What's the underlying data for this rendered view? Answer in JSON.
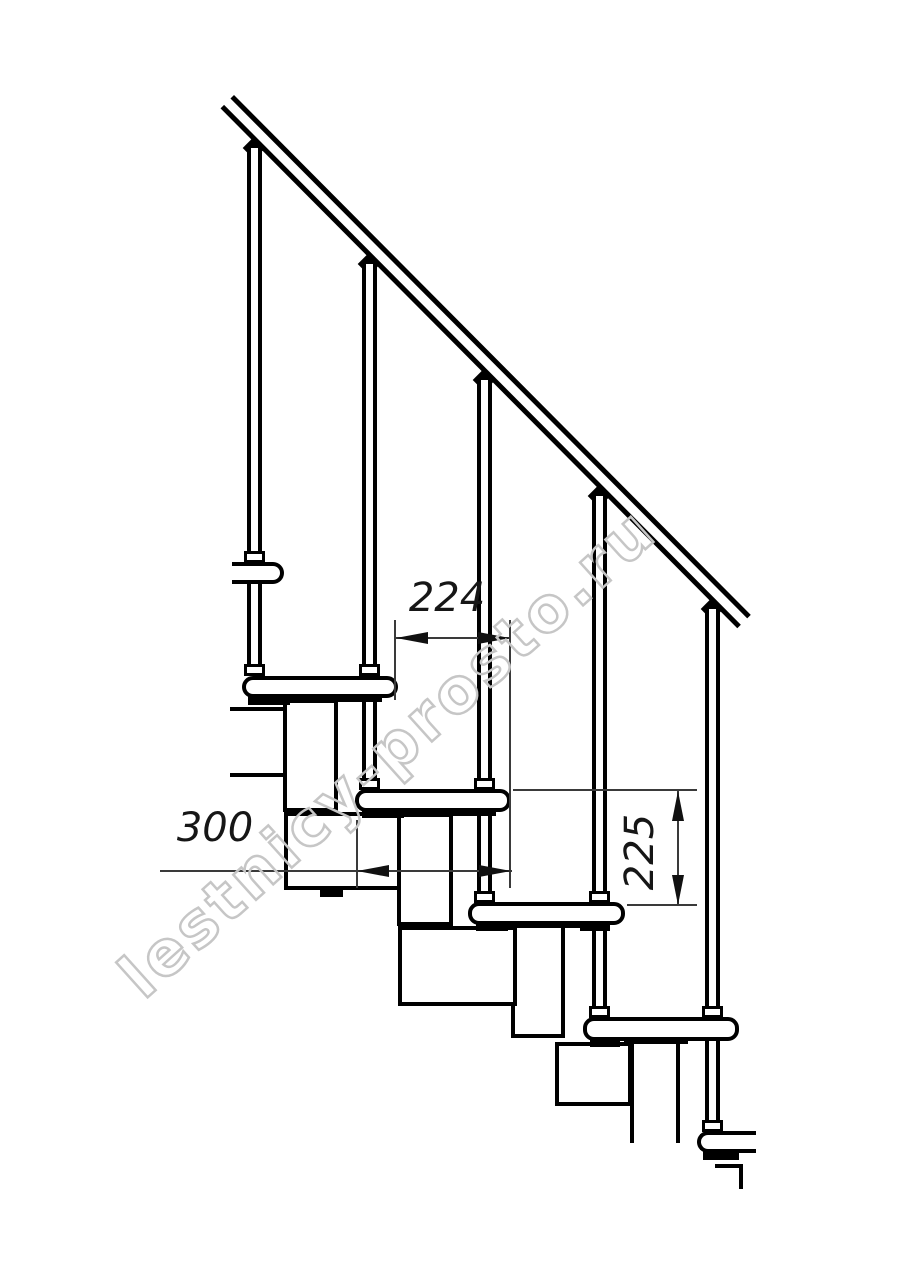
{
  "drawing": {
    "kind": "modular-staircase-side-view",
    "watermark": "lestnicy-prosto.ru",
    "dimensions": {
      "step_run": "224",
      "tread_depth": "300",
      "step_rise": "225"
    },
    "colors": {
      "line": "#000000",
      "dimension_line": "#3a3a3a",
      "watermark_outline": "#c6c6c6",
      "background": "#ffffff"
    }
  }
}
